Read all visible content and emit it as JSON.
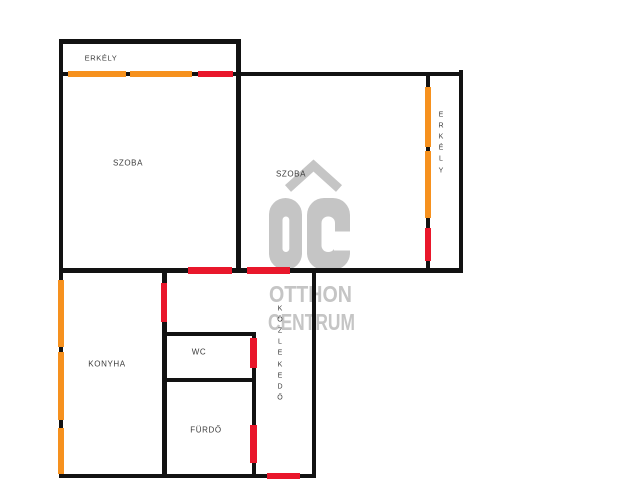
{
  "canvas": {
    "w": 625,
    "h": 500
  },
  "colors": {
    "wall": "#121212",
    "window": "#f6911e",
    "door": "#e9172b",
    "label": "#3b3b3b",
    "watermark": "#c5c5c5",
    "background": "#ffffff"
  },
  "watermark": {
    "logo": "ÓC",
    "line1": "OTTHON",
    "line2": "CENTRUM"
  },
  "labels": [
    {
      "name": "erkely-top",
      "text": "ERKÉLY",
      "cx": 101,
      "cy": 58,
      "vertical": false,
      "size": 7.5
    },
    {
      "name": "szoba-left",
      "text": "SZOBA",
      "cx": 128,
      "cy": 163,
      "vertical": false,
      "size": 8
    },
    {
      "name": "szoba-right",
      "text": "SZOBA",
      "cx": 291,
      "cy": 174,
      "vertical": false,
      "size": 8
    },
    {
      "name": "erkely-right",
      "text": "ERKÉLY",
      "cx": 441,
      "cy": 142.5,
      "vertical": true,
      "size": 7
    },
    {
      "name": "konyha",
      "text": "KONYHA",
      "cx": 107,
      "cy": 364,
      "vertical": false,
      "size": 8
    },
    {
      "name": "wc",
      "text": "WC",
      "cx": 199,
      "cy": 352,
      "vertical": false,
      "size": 8
    },
    {
      "name": "furdo",
      "text": "FÜRDŐ",
      "cx": 206,
      "cy": 430,
      "vertical": false,
      "size": 8
    },
    {
      "name": "kozlekedo",
      "text": "KÖZLEKEDŐ",
      "cx": 280,
      "cy": 353.5,
      "vertical": true,
      "size": 7
    }
  ],
  "walls": [
    {
      "name": "wall-outer-left",
      "x": 58.5,
      "y": 39,
      "w": 4.5,
      "h": 439
    },
    {
      "name": "wall-balcony-top",
      "x": 58.5,
      "y": 39,
      "w": 182,
      "h": 4.5
    },
    {
      "name": "wall-upper-horizontal",
      "x": 58.5,
      "y": 71.5,
      "w": 404.5,
      "h": 4.5
    },
    {
      "name": "wall-szoba-divider",
      "x": 236,
      "y": 39,
      "w": 4.5,
      "h": 233.5
    },
    {
      "name": "wall-balcony-right-sep",
      "x": 425.5,
      "y": 71.5,
      "w": 4.5,
      "h": 201
    },
    {
      "name": "wall-outer-right",
      "x": 458.5,
      "y": 70,
      "w": 4.5,
      "h": 202.5
    },
    {
      "name": "wall-main-horizontal",
      "x": 58.5,
      "y": 268,
      "w": 404.5,
      "h": 4.5
    },
    {
      "name": "wall-konyha-right",
      "x": 162,
      "y": 268,
      "w": 4.5,
      "h": 210
    },
    {
      "name": "wall-wc-top",
      "x": 162,
      "y": 332,
      "w": 94,
      "h": 4.2
    },
    {
      "name": "wall-wc-furdo-divider",
      "x": 162,
      "y": 378,
      "w": 94,
      "h": 4.2
    },
    {
      "name": "wall-wc-right",
      "x": 251.5,
      "y": 332,
      "w": 4.5,
      "h": 146
    },
    {
      "name": "wall-corridor-right",
      "x": 311.5,
      "y": 268,
      "w": 4.5,
      "h": 210
    },
    {
      "name": "wall-bottom",
      "x": 58.5,
      "y": 473.5,
      "w": 257.5,
      "h": 4.5
    }
  ],
  "windows": [
    {
      "name": "window-balcony-1",
      "x": 68,
      "y": 70.5,
      "w": 58,
      "h": 6.5
    },
    {
      "name": "window-balcony-2",
      "x": 130,
      "y": 70.5,
      "w": 62,
      "h": 6.5
    },
    {
      "name": "window-right-balcony-1",
      "x": 424.5,
      "y": 87,
      "w": 6.5,
      "h": 60
    },
    {
      "name": "window-right-balcony-2",
      "x": 424.5,
      "y": 151,
      "w": 6.5,
      "h": 67
    },
    {
      "name": "window-konyha-1",
      "x": 57.5,
      "y": 280,
      "w": 6.5,
      "h": 67
    },
    {
      "name": "window-konyha-2",
      "x": 57.5,
      "y": 352,
      "w": 6.5,
      "h": 68
    },
    {
      "name": "window-konyha-3",
      "x": 57.5,
      "y": 428,
      "w": 6.5,
      "h": 45.5
    }
  ],
  "doors": [
    {
      "name": "door-balcony-top",
      "x": 198,
      "y": 70.5,
      "w": 35,
      "h": 6.5
    },
    {
      "name": "door-szoba-left",
      "x": 188,
      "y": 267,
      "w": 44,
      "h": 6.5
    },
    {
      "name": "door-szoba-right",
      "x": 246.5,
      "y": 267,
      "w": 43.5,
      "h": 6.5
    },
    {
      "name": "door-konyha",
      "x": 160.75,
      "y": 282.5,
      "w": 6.5,
      "h": 39
    },
    {
      "name": "door-balcony-right",
      "x": 424.5,
      "y": 227.5,
      "w": 6.5,
      "h": 33
    },
    {
      "name": "door-wc",
      "x": 250.25,
      "y": 338,
      "w": 6.5,
      "h": 30
    },
    {
      "name": "door-furdo",
      "x": 250.25,
      "y": 425,
      "w": 6.5,
      "h": 38
    },
    {
      "name": "door-entrance",
      "x": 267,
      "y": 472.5,
      "w": 33,
      "h": 6.5
    }
  ]
}
